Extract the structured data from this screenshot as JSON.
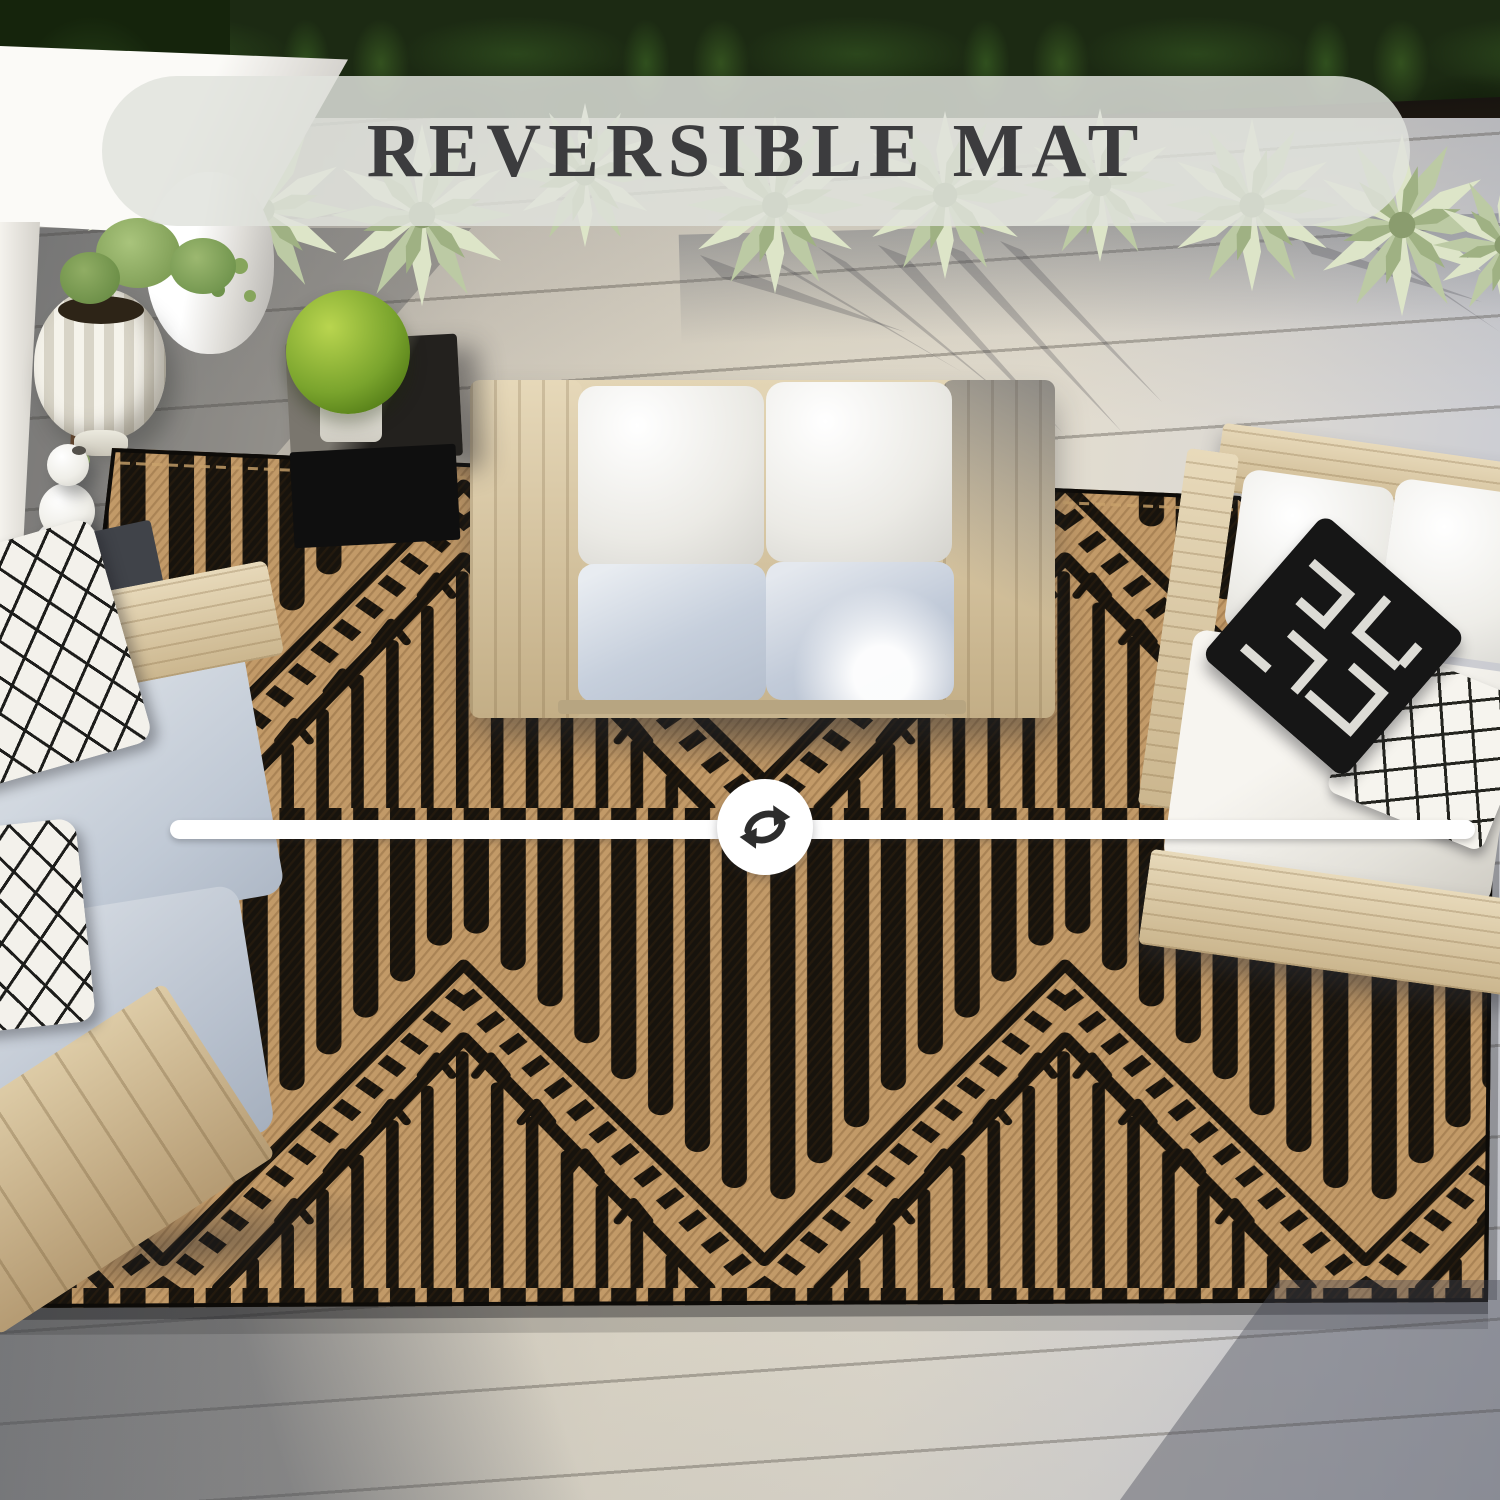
{
  "banner": {
    "label": "REVERSIBLE MAT",
    "background": "rgba(224,226,220,0.84)",
    "text_color": "#3c3c3e"
  },
  "divider": {
    "icon": "reverse-arrows-icon",
    "bar_color": "#ffffff",
    "icon_color": "#2d2d2d"
  },
  "scene": {
    "description": "top-down outdoor patio with reversible woven mat, wood-frame sofas with white and gray cushions, agave planter hedge, black cube side table with green ball plant, white pots on gray deck",
    "palette": {
      "rug_black": "#17130d",
      "rug_tan": "#c29a68",
      "hedge_green": "#1c2a13",
      "agave_green": "#dde5c8",
      "deck_light": "#e1dac9",
      "deck_shadow": "#4b4e58",
      "wood_frame": "#d9c8a4",
      "cushion_white": "#f4f3ef",
      "cushion_gray": "#c2cbd8",
      "pillow_black": "#161616",
      "plant_ball_green": "#7aa42d",
      "table_black": "#101010",
      "wall_white": "#f6f4ef"
    }
  }
}
